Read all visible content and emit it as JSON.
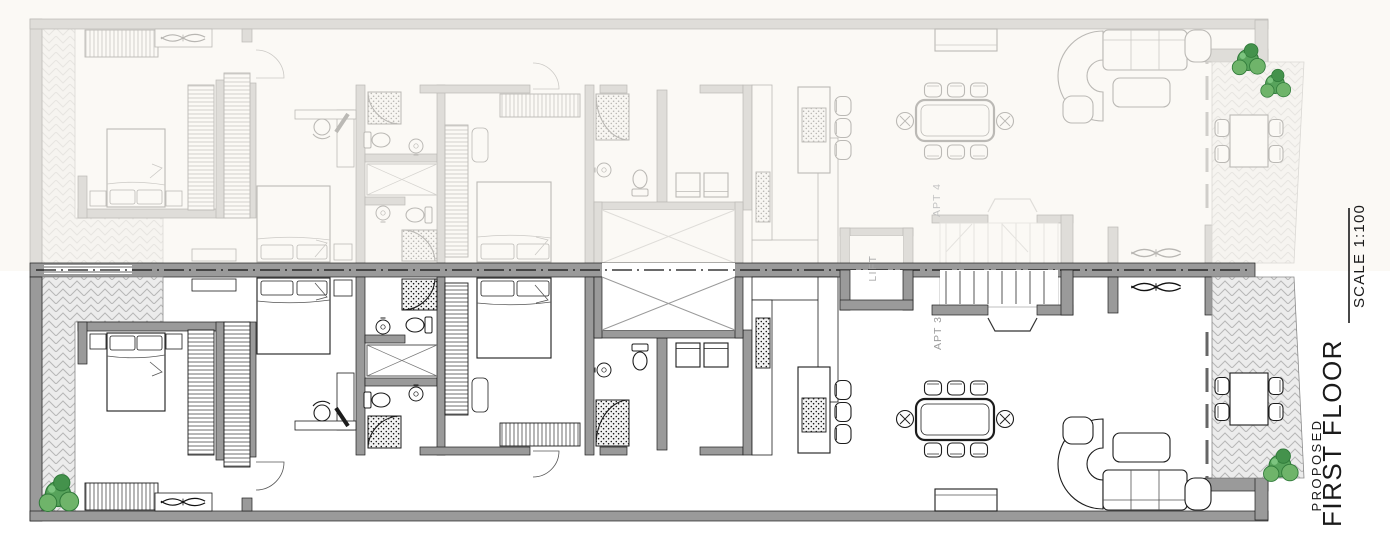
{
  "title_block": {
    "title": "FIRST FLOOR",
    "subtitle": "PROPOSED",
    "scale_label": "SCALE 1:100"
  },
  "unit_labels": {
    "upper_apartment": "APT 4",
    "lower_apartment": "APT 3",
    "lift": "LIFT"
  },
  "colors": {
    "background": "#ffffff",
    "wall_fill": "#9a9a9a",
    "line_dark": "#1c1c1c",
    "faded_overlay": "#faf6f1",
    "paving_hatch_line": "#b7b7b7",
    "paving_hatch_bg": "#ececec",
    "plant_green": "#57a35b",
    "plant_green_dark": "#2f7a39",
    "label_grey": "#9b9b9b",
    "faded_label_grey": "#c4c4c4"
  },
  "icon_names": [
    "double-bed-icon",
    "single-bed-icon",
    "wardrobe-icon",
    "ceiling-fan-icon",
    "plant-icon",
    "toilet-icon",
    "sink-icon",
    "shower-icon",
    "washing-machine-icon",
    "kitchen-island-icon",
    "bar-stool-icon",
    "dining-table-icon",
    "dining-chair-icon",
    "sideboard-icon",
    "sofa-icon",
    "coffee-table-icon",
    "outdoor-table-icon",
    "stairs-icon",
    "lift-shaft",
    "light-well",
    "terrace-paving",
    "party-wall",
    "entrance-door-icon",
    "desk-icon",
    "desk-chair-icon"
  ]
}
